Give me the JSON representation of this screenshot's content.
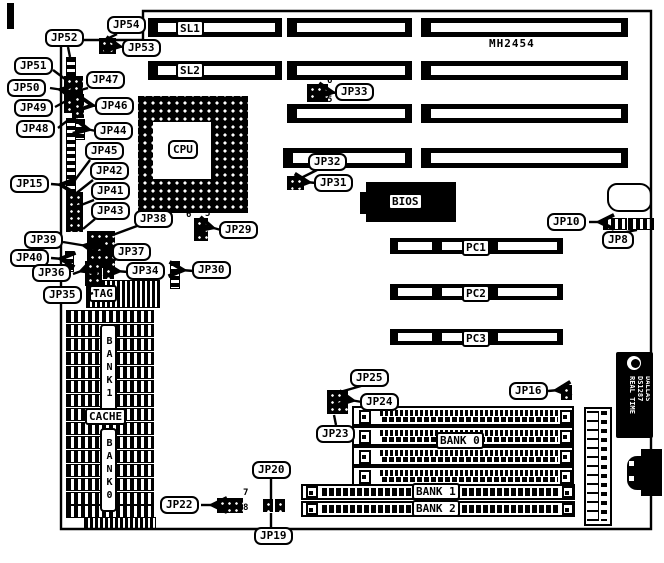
{
  "board": {
    "model": "MH2454"
  },
  "slots": {
    "sl1": "SL1",
    "sl2": "SL2",
    "pc1": "PC1",
    "pc2": "PC2",
    "pc3": "PC3"
  },
  "chips": {
    "cpu": "CPU",
    "bios": "BIOS",
    "tag": "TAG",
    "cache": "CACHE"
  },
  "memory": {
    "bank0": "BANK 0",
    "bank1": "BANK 1",
    "bank2": "BANK 2",
    "cache_bank1": "BANK1",
    "cache_bank0": "BANK0"
  },
  "rtc": {
    "brand": "DALLAS",
    "part": "DS1287",
    "label": "REAL TIME"
  },
  "jumpers": {
    "jp8": "JP8",
    "jp10": "JP10",
    "jp15": "JP15",
    "jp16": "JP16",
    "jp19": "JP19",
    "jp20": "JP20",
    "jp22": "JP22",
    "jp23": "JP23",
    "jp24": "JP24",
    "jp25": "JP25",
    "jp29": "JP29",
    "jp30": "JP30",
    "jp31": "JP31",
    "jp32": "JP32",
    "jp33": "JP33",
    "jp34": "JP34",
    "jp35": "JP35",
    "jp36": "JP36",
    "jp37": "JP37",
    "jp38": "JP38",
    "jp39": "JP39",
    "jp40": "JP40",
    "jp41": "JP41",
    "jp42": "JP42",
    "jp43": "JP43",
    "jp44": "JP44",
    "jp45": "JP45",
    "jp46": "JP46",
    "jp47": "JP47",
    "jp48": "JP48",
    "jp49": "JP49",
    "jp50": "JP50",
    "jp51": "JP51",
    "jp52": "JP52",
    "jp53": "JP53",
    "jp54": "JP54"
  },
  "pins": {
    "jp33_6": "6",
    "jp33_5": "5",
    "jp29_6": "6",
    "jp29_5": "5",
    "jp34_3": "3",
    "jp22_7": "7",
    "jp22_8": "8"
  }
}
